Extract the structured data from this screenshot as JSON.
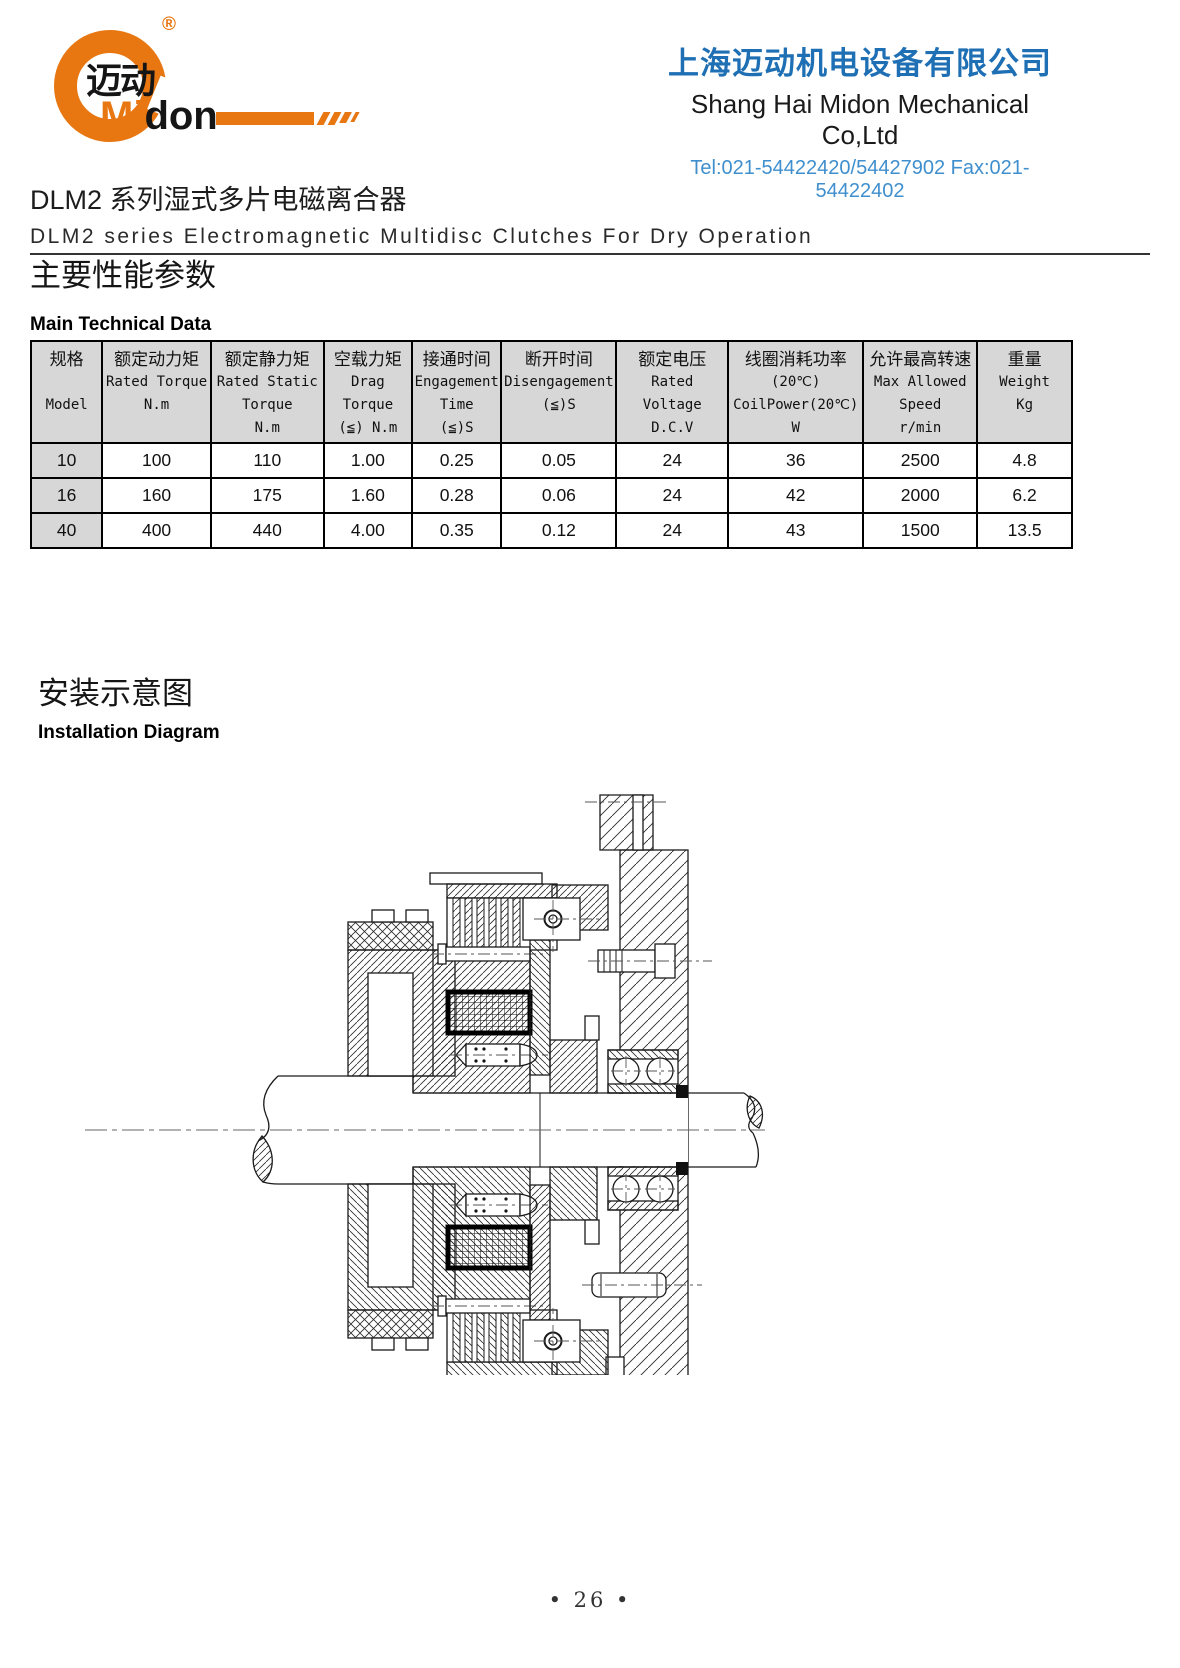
{
  "header": {
    "logo": {
      "cn": "迈动",
      "en_orange": "Mi",
      "en_black": "don",
      "registered": "®"
    },
    "company_cn": "上海迈动机电设备有限公司",
    "company_en": "Shang Hai Midon Mechanical Co,Ltd",
    "contact": "Tel:021-54422420/54427902 Fax:021-54422402"
  },
  "title": {
    "cn": "DLM2 系列湿式多片电磁离合器",
    "en": "DLM2 series Electromagnetic Multidisc Clutches For Dry Operation"
  },
  "section_params": {
    "cn": "主要性能参数",
    "en": "Main Technical Data"
  },
  "table": {
    "columns": [
      {
        "w": "6.7%",
        "lines": [
          "规格",
          "",
          "Model",
          ""
        ]
      },
      {
        "w": "10.2%",
        "lines": [
          "额定动力矩",
          "Rated Torque",
          "N.m",
          ""
        ]
      },
      {
        "w": "10.6%",
        "lines": [
          "额定静力矩",
          "Rated Static",
          "Torque",
          "N.m"
        ]
      },
      {
        "w": "8.3%",
        "lines": [
          "空载力矩",
          "Drag",
          "Torque",
          "(≦) N.m"
        ]
      },
      {
        "w": "8.4%",
        "lines": [
          "接通时间",
          "Engagement",
          "Time",
          "(≦)S"
        ]
      },
      {
        "w": "10.8%",
        "lines": [
          "断开时间",
          "Disengagement",
          "(≦)S",
          ""
        ]
      },
      {
        "w": "10.5%",
        "lines": [
          "额定电压",
          "Rated",
          "Voltage",
          "D.C.V"
        ]
      },
      {
        "w": "12.7%",
        "lines": [
          "线圈消耗功率",
          "(20℃)",
          "CoilPower(20℃)",
          "W"
        ]
      },
      {
        "w": "10.7%",
        "lines": [
          "允许最高转速",
          "Max Allowed",
          "Speed",
          "r/min"
        ]
      },
      {
        "w": "8.9%",
        "lines": [
          "重量",
          "Weight",
          "Kg",
          ""
        ]
      }
    ],
    "rows": [
      [
        "10",
        "100",
        "110",
        "1.00",
        "0.25",
        "0.05",
        "24",
        "36",
        "2500",
        "4.8"
      ],
      [
        "16",
        "160",
        "175",
        "1.60",
        "0.28",
        "0.06",
        "24",
        "42",
        "2000",
        "6.2"
      ],
      [
        "40",
        "400",
        "440",
        "4.00",
        "0.35",
        "0.12",
        "24",
        "43",
        "1500",
        "13.5"
      ]
    ]
  },
  "section_install": {
    "cn": "安装示意图",
    "en": "Installation Diagram"
  },
  "footer": {
    "page": "• 26 •"
  },
  "colors": {
    "accent_orange": "#e87712",
    "brand_blue": "#1e6fb4",
    "light_blue": "#3f8fce",
    "table_header_bg": "#d7d7d7"
  }
}
